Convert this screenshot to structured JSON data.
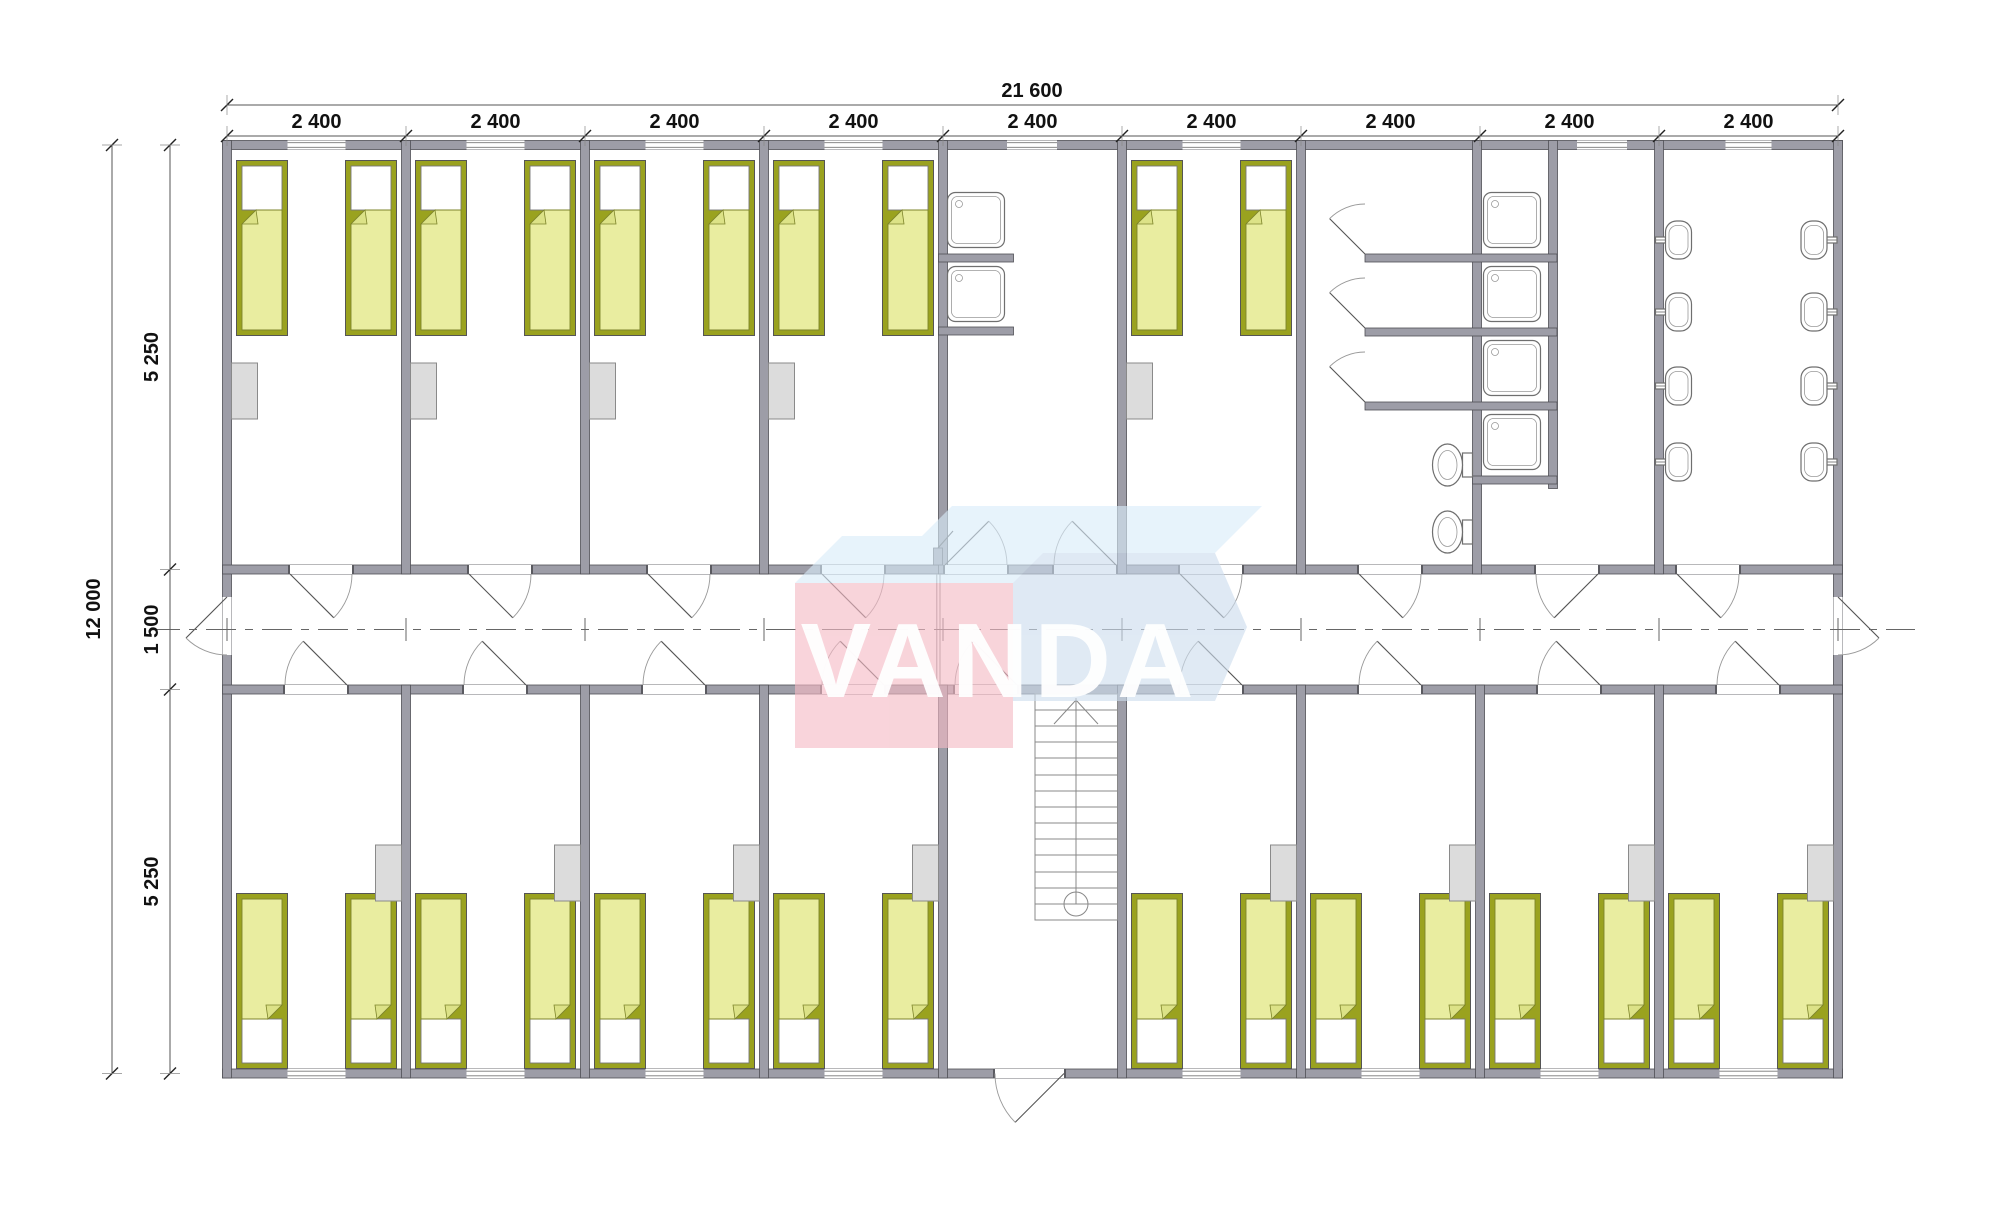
{
  "dimensions": {
    "top_total": "21 600",
    "top_modules": [
      "2 400",
      "2 400",
      "2 400",
      "2 400",
      "2 400",
      "2 400",
      "2 400",
      "2 400",
      "2 400"
    ],
    "left_total": "12 000",
    "left_segments": [
      "5 250",
      "1 500",
      "5 250"
    ]
  },
  "logo": {
    "text": "VANDA"
  },
  "colors": {
    "wall_fill": "#9d9da7",
    "wall_stroke": "#4f4f55",
    "bed_frame": "#9aa21f",
    "bed_blanket": "#e9eda0",
    "bed_fold": "#dce287",
    "wardrobe_fill": "#dcdcdc",
    "wardrobe_stroke": "#8a8a8a",
    "fixture_stroke": "#6f6f6f",
    "dim_color": "#111111",
    "logo_pink": "#f5bac5",
    "logo_blue": "#cdddee",
    "logo_blue_top": "#d9ecfa",
    "logo_text": "#ffffff"
  },
  "plan": {
    "building": {
      "total_width_mm": 21600,
      "total_depth_mm": 12000,
      "modules": 9,
      "module_width_mm": 2400,
      "corridor_width_mm": 1500,
      "room_depth_mm": 5250
    },
    "inventory": {
      "bedrooms": 10,
      "beds": 26,
      "wardrobes": 13,
      "shower_trays": 6,
      "toilet_stalls": 3,
      "wall_hung_toilets": 2,
      "wash_basins": 8,
      "staircases": 1,
      "corridor_exit_doors": 2,
      "main_entrance_doors": 1
    }
  }
}
